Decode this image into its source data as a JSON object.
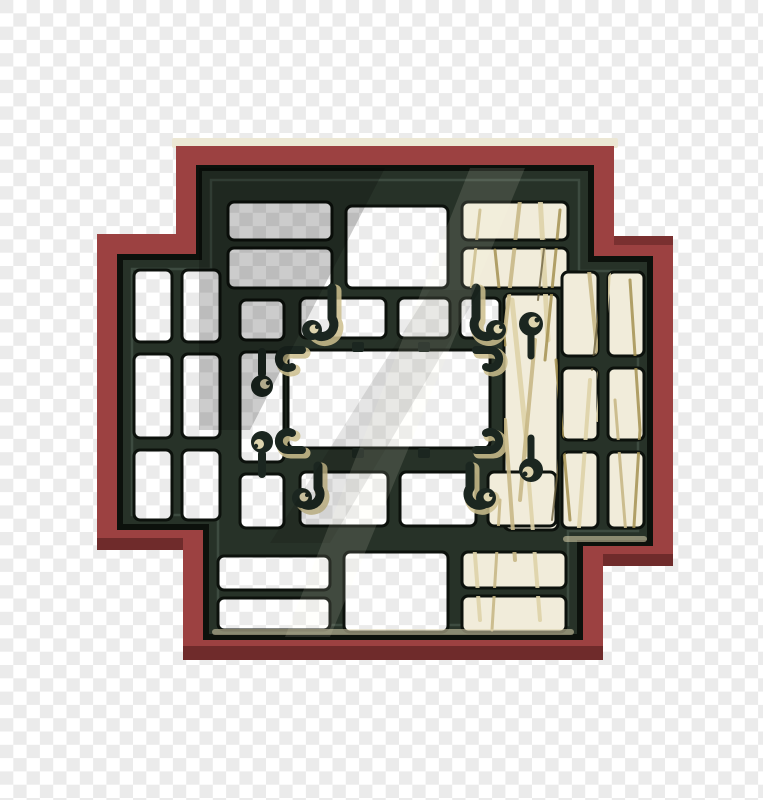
{
  "image": {
    "subject": "Traditional Chinese lattice window",
    "description": "Carved dark-green wooden lattice window set in a stepped brick-red cross-shaped frame, with dried grass visible behind the right-hand panes, displayed over a transparent checkerboard background"
  },
  "background": {
    "style": "transparency-checkerboard",
    "square_size_px": 13.3,
    "color_light": "#ffffff",
    "color_dark": "#ebebeb"
  },
  "window": {
    "frame_color": "#9c4141",
    "frame_shadow_color": "#6f2b2b",
    "frame_highlight_color": "#ece7d4",
    "lattice_color": "#273228",
    "lattice_dark_color": "#0c110c",
    "lattice_light_color": "#4a594d",
    "hook_color": "#1b2620",
    "accent_gold_color": "#cdbf8e",
    "accent_cream_color": "#ddd4ae",
    "grass_base_color": "#f1ecda",
    "grass_stroke_1": "#ded3a8",
    "grass_stroke_2": "#c8b987",
    "grass_stroke_3": "#a59252",
    "grass_stroke_dark": "#6e6340"
  }
}
